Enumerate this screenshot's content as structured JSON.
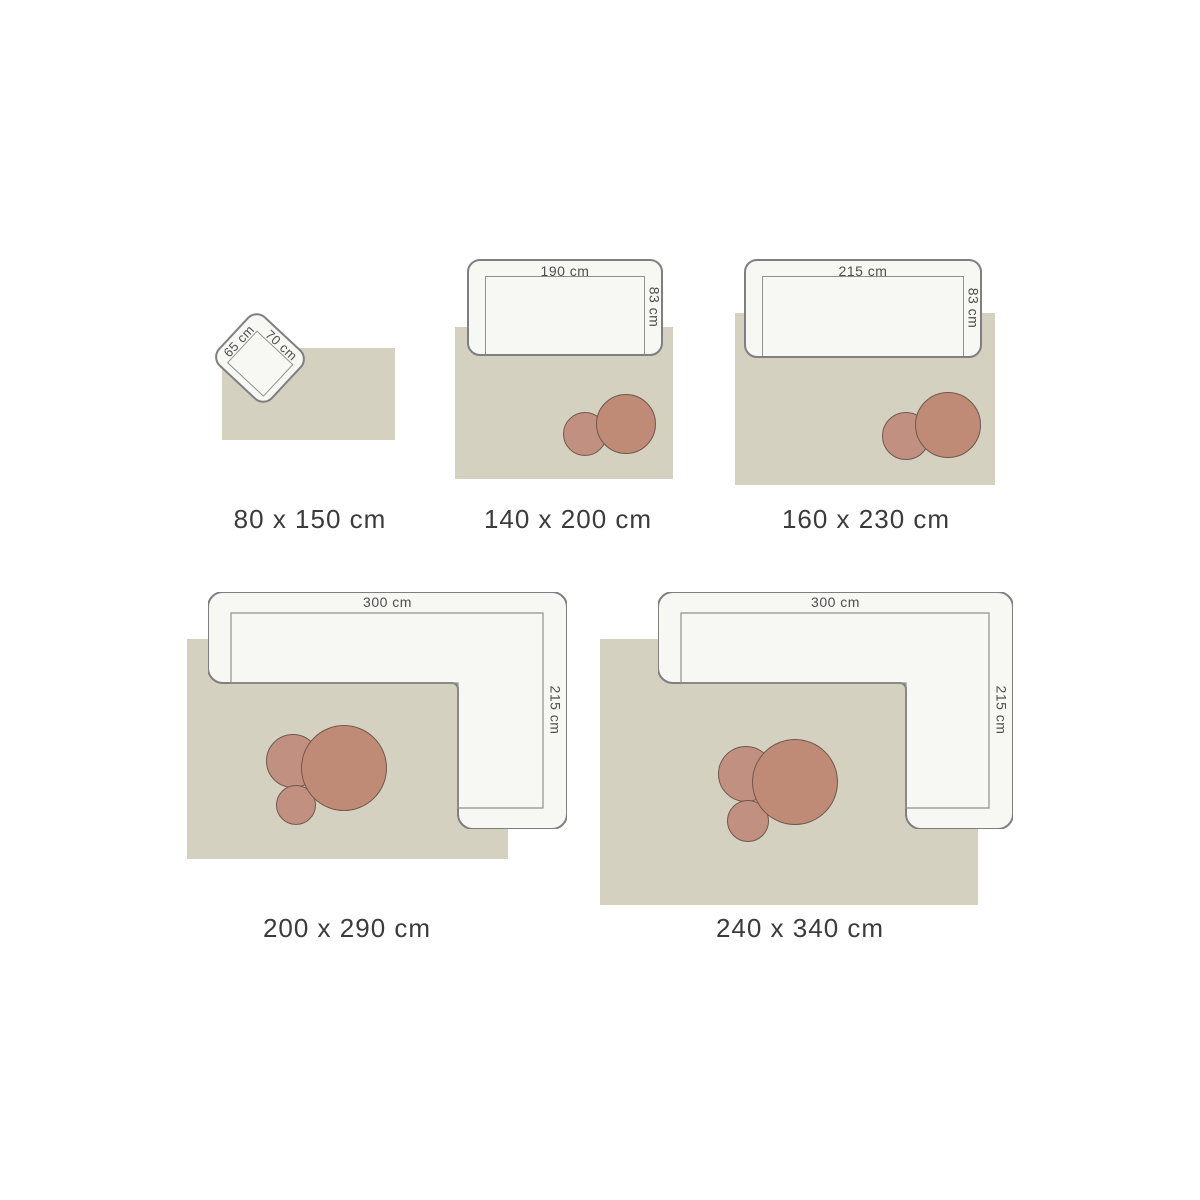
{
  "palette": {
    "page_bg": "#ffffff",
    "rug": "#d4d1c0",
    "sofa_fill": "#f7f7f4",
    "sofa_border": "#7f7f81",
    "seat_border": "#90908d",
    "table_large": "#bf8a76",
    "table_small": "#c29080",
    "table_border": "#6f584c",
    "label_color": "#3b3b3b",
    "dim_color": "#4e4e4e"
  },
  "groups": [
    {
      "id": "rug-80x150",
      "size_label": "80 x 150 cm",
      "furniture": "armchair",
      "furniture_dims": {
        "side_a": "65 cm",
        "side_b": "70 cm"
      }
    },
    {
      "id": "rug-140x200",
      "size_label": "140 x 200 cm",
      "furniture": "sofa",
      "furniture_dims": {
        "width": "190 cm",
        "depth": "83 cm"
      }
    },
    {
      "id": "rug-160x230",
      "size_label": "160 x 230 cm",
      "furniture": "sofa",
      "furniture_dims": {
        "width": "215 cm",
        "depth": "83 cm"
      }
    },
    {
      "id": "rug-200x290",
      "size_label": "200 x 290 cm",
      "furniture": "corner-sofa",
      "furniture_dims": {
        "width": "300 cm",
        "depth": "215 cm"
      }
    },
    {
      "id": "rug-240x340",
      "size_label": "240 x 340 cm",
      "furniture": "corner-sofa",
      "furniture_dims": {
        "width": "300 cm",
        "depth": "215 cm"
      }
    }
  ]
}
